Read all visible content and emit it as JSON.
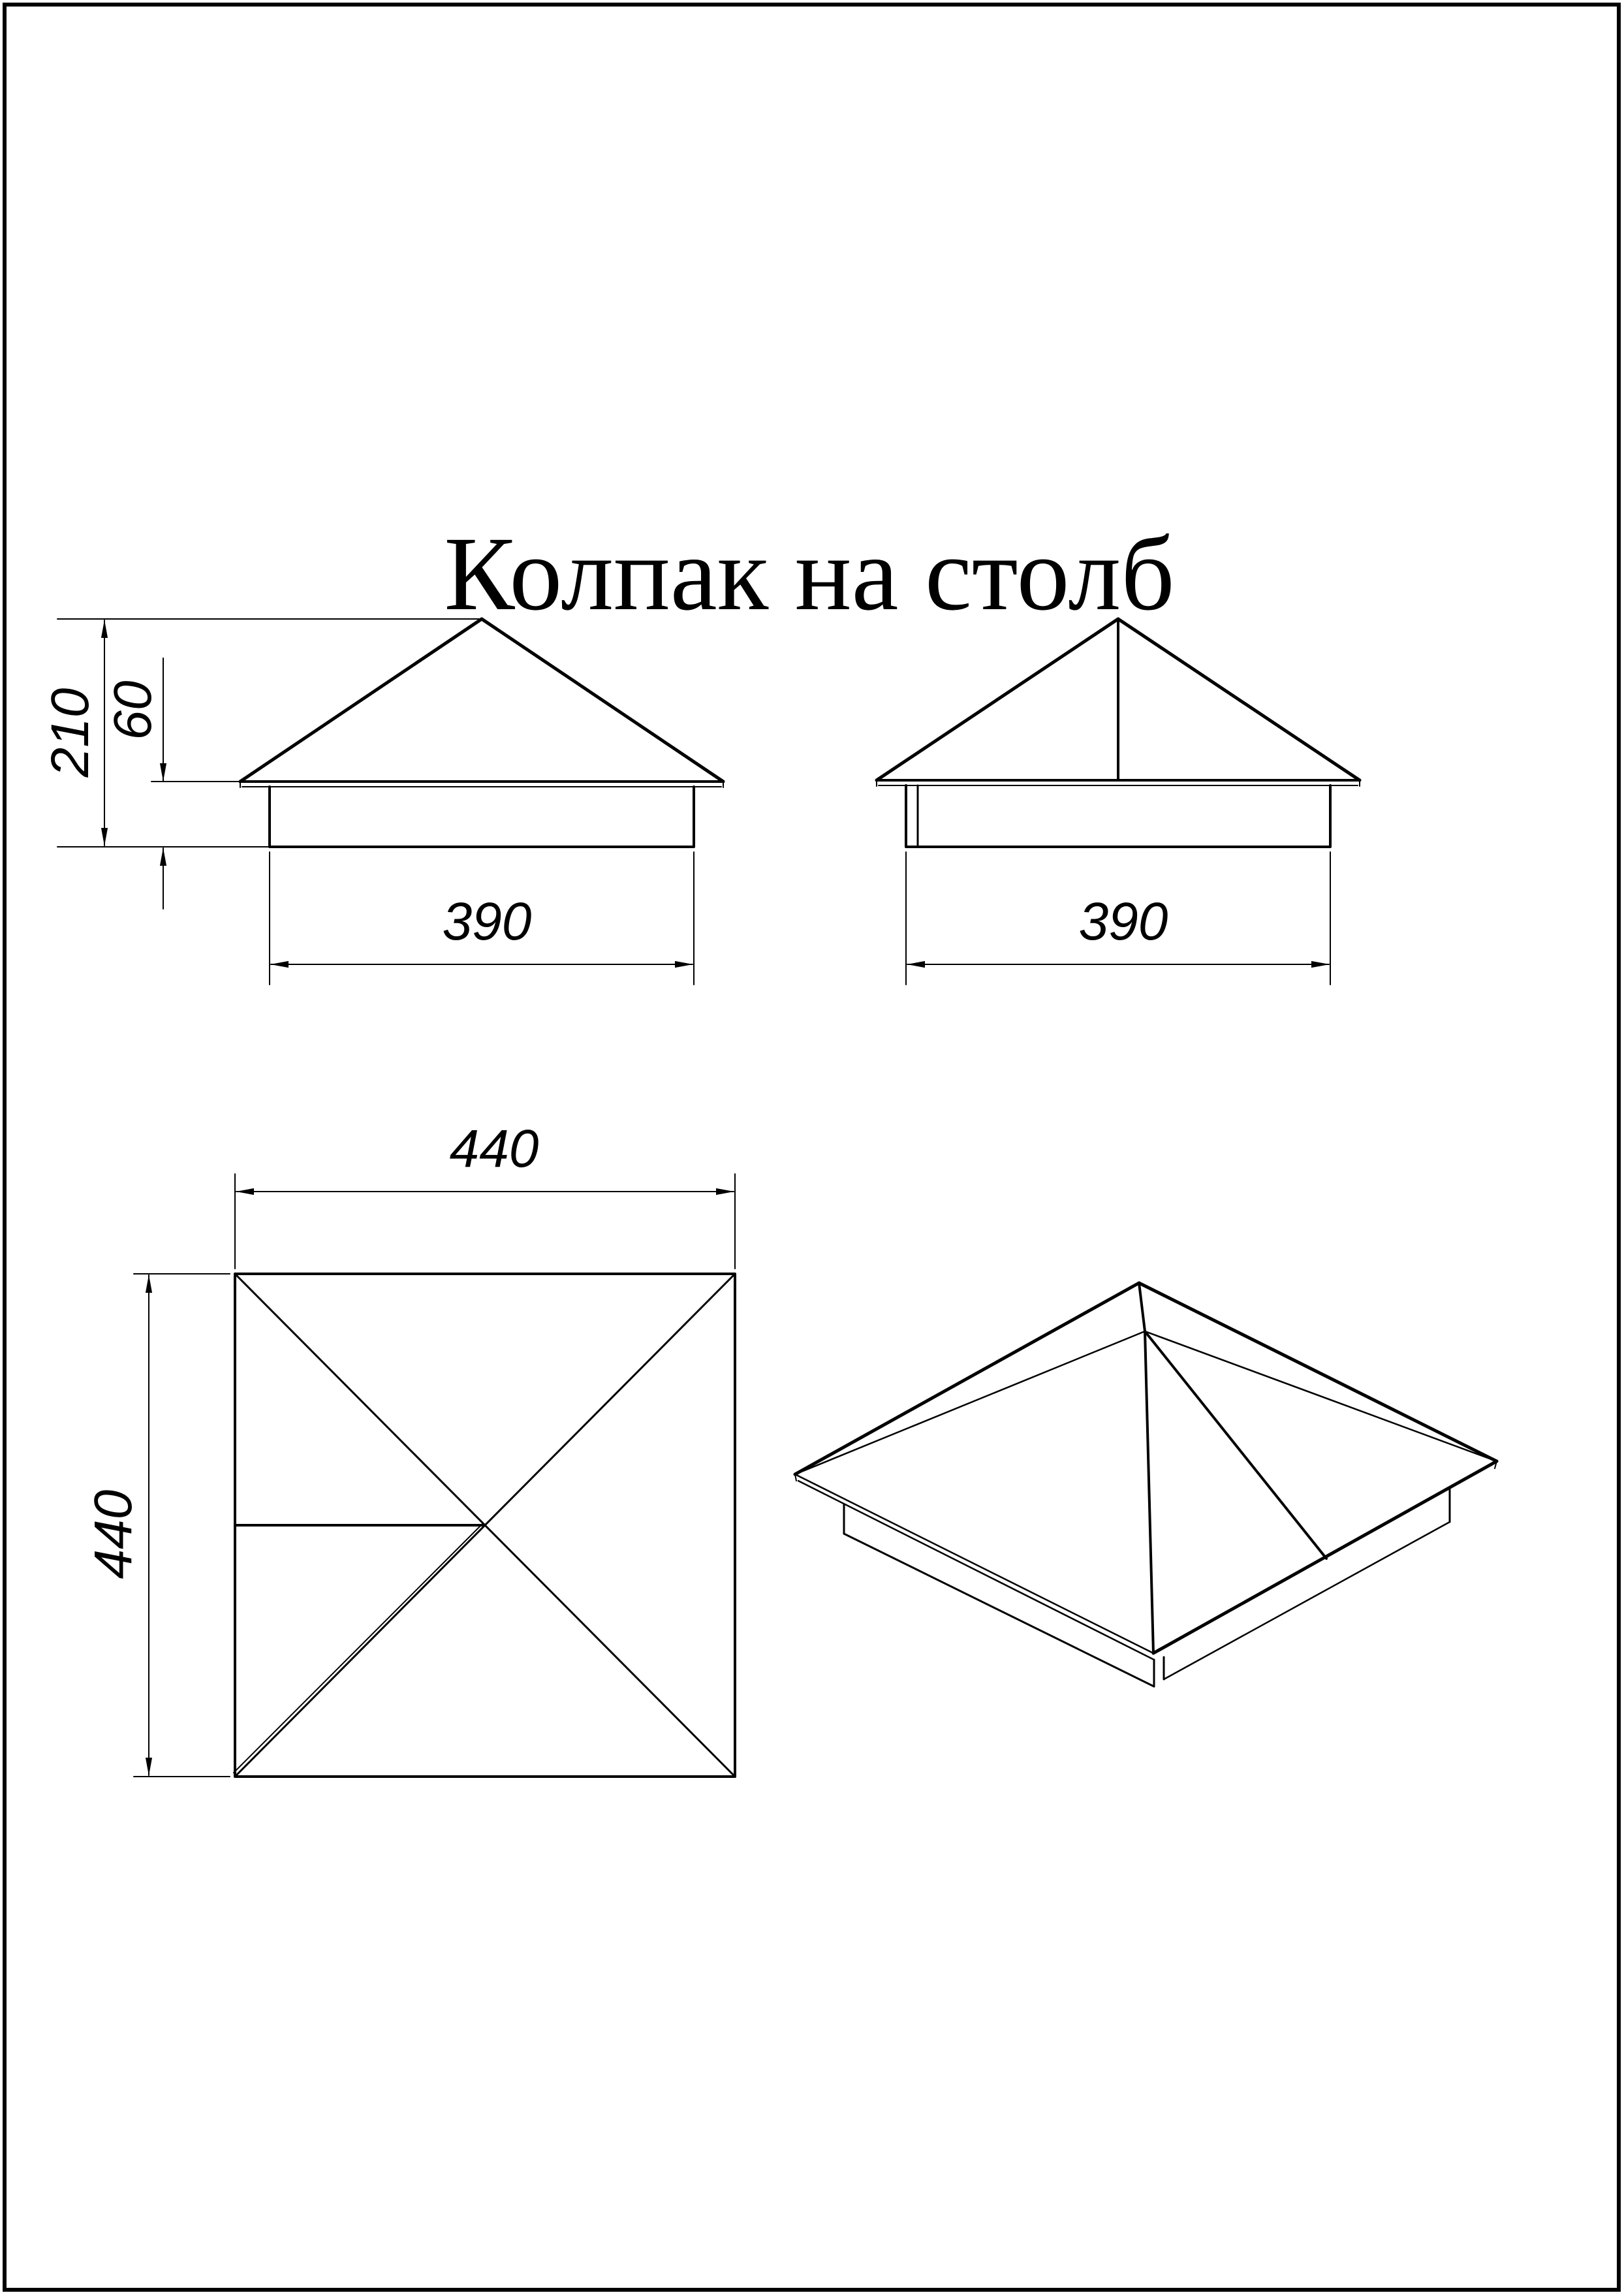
{
  "page": {
    "background_color": "#ffffff",
    "line_color": "#000000",
    "frame": "thin black rectangular page border"
  },
  "title": {
    "text": "Колпак на столб"
  },
  "views": {
    "front_view": {
      "description": "front elevation of pyramid post cap with skirt",
      "dims": {
        "total_height": "210",
        "skirt_height": "60",
        "skirt_width": "390"
      }
    },
    "side_view": {
      "description": "side elevation with visible ridge line",
      "dims": {
        "skirt_width": "390"
      }
    },
    "top_view": {
      "description": "plan view, square with diagonals and seam lines",
      "dims": {
        "width": "440",
        "depth": "440"
      }
    },
    "isometric_view": {
      "description": "3D view of pyramid cap with eaves rim, seam and skirt"
    }
  }
}
